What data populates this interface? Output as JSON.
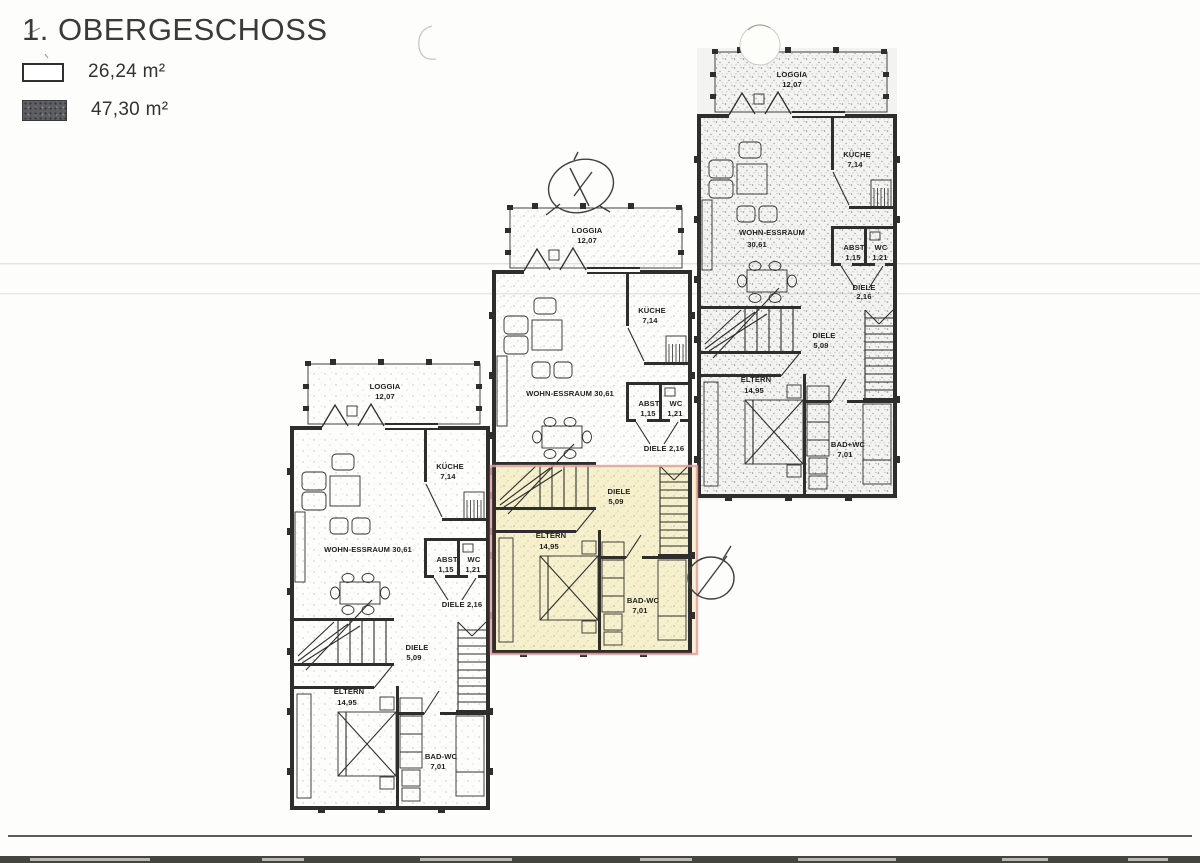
{
  "title": "1. OBERGESCHOSS",
  "legend": {
    "items": [
      {
        "swatch": "outline-white",
        "label": "26,24 m²"
      },
      {
        "swatch": "hatched-dark",
        "label": "47,30 m²"
      }
    ]
  },
  "units": [
    {
      "name": "unit-bottom-left",
      "origin": [
        290,
        360
      ],
      "stipple": "stipL",
      "shade": false,
      "highlight": false,
      "labels": {
        "loggia": [
          "LOGGIA",
          "12,07"
        ],
        "kueche": [
          "KÜCHE",
          "7,14"
        ],
        "wohn": [
          "WOHN-ESSRAUM 30,61"
        ],
        "abst": [
          "ABST",
          "1,15"
        ],
        "wc": [
          "WC",
          "1,21"
        ],
        "diele2": [
          "DIELE 2,16"
        ],
        "diele5": [
          "DIELE",
          "5,09"
        ],
        "eltern": [
          "ELTERN",
          "14,95"
        ],
        "bad": [
          "BAD-WC",
          "7,01"
        ]
      }
    },
    {
      "name": "unit-middle",
      "origin": [
        492,
        204
      ],
      "stipple": "stipM",
      "shade": false,
      "highlight": true,
      "labels": {
        "loggia": [
          "LOGGIA",
          "12,07"
        ],
        "kueche": [
          "KÜCHE",
          "7,14"
        ],
        "wohn": [
          "WOHN-ESSRAUM 30,61"
        ],
        "abst": [
          "ABST",
          "1,15"
        ],
        "wc": [
          "WC",
          "1,21"
        ],
        "diele2": [
          "DIELE 2,16"
        ],
        "diele5": [
          "DIELE",
          "5,09"
        ],
        "eltern": [
          "ELTERN",
          "14,95"
        ],
        "bad": [
          "BAD-WC",
          "7,01"
        ]
      }
    },
    {
      "name": "unit-top-right",
      "origin": [
        697,
        48
      ],
      "stipple": "stipD",
      "shade": true,
      "highlight": false,
      "labels": {
        "loggia": [
          "LOGGIA",
          "12,07"
        ],
        "kueche": [
          "KÜCHE",
          "7,14"
        ],
        "wohn": [
          "WOHN-ESSRAUM",
          "30,61"
        ],
        "abst": [
          "ABST",
          "1,15"
        ],
        "wc": [
          "WC",
          "1,21"
        ],
        "diele2": [
          "DIELE",
          "2,16"
        ],
        "diele5": [
          "DIELE",
          "5,09"
        ],
        "eltern": [
          "ELTERN",
          "14,95"
        ],
        "bad": [
          "BAD+WC",
          "7,01"
        ]
      }
    }
  ],
  "highlight_colors": {
    "fill": "#f5efc3",
    "border": "#e2a0a0"
  },
  "annotations": [
    {
      "name": "pencil-oval-scribble"
    },
    {
      "name": "pencil-oval-slash"
    },
    {
      "name": "correction-fluid-blob"
    },
    {
      "name": "scan-smudge-arc"
    }
  ]
}
